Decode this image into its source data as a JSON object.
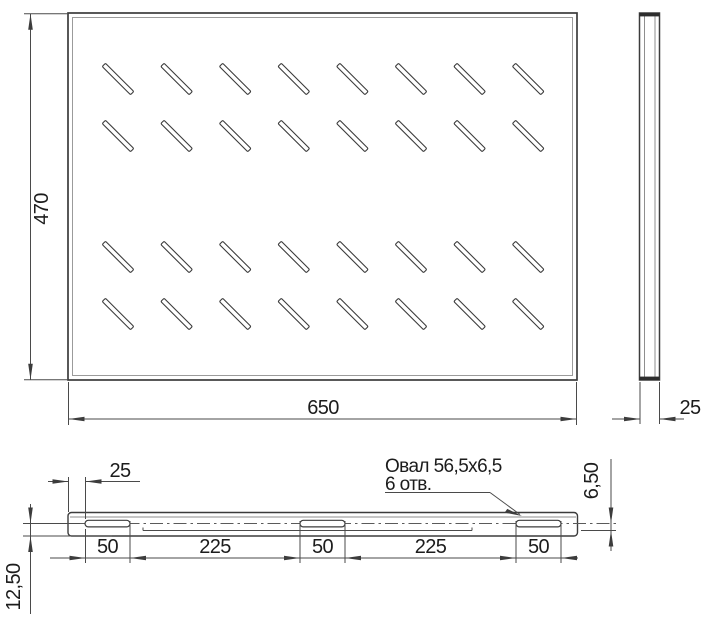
{
  "drawing": {
    "title": "shelf-technical-drawing",
    "top_view": {
      "width_label": "650",
      "height_label": "470"
    },
    "side_view": {
      "depth_label": "25"
    },
    "front_view": {
      "edge_offset_label": "25",
      "segment_labels": [
        "50",
        "225",
        "50",
        "225",
        "50"
      ],
      "flange_height_label": "12,50",
      "slot_offset_label": "6,50",
      "slot_note_line1": "Овал 56,5x6,5",
      "slot_note_line2": "6 отв."
    },
    "slot_grid": {
      "rows": 4,
      "cols": 8
    },
    "colors": {
      "line": "#3c3c3c",
      "line_light": "#8e8e8e",
      "text": "#1c1c1c"
    }
  }
}
